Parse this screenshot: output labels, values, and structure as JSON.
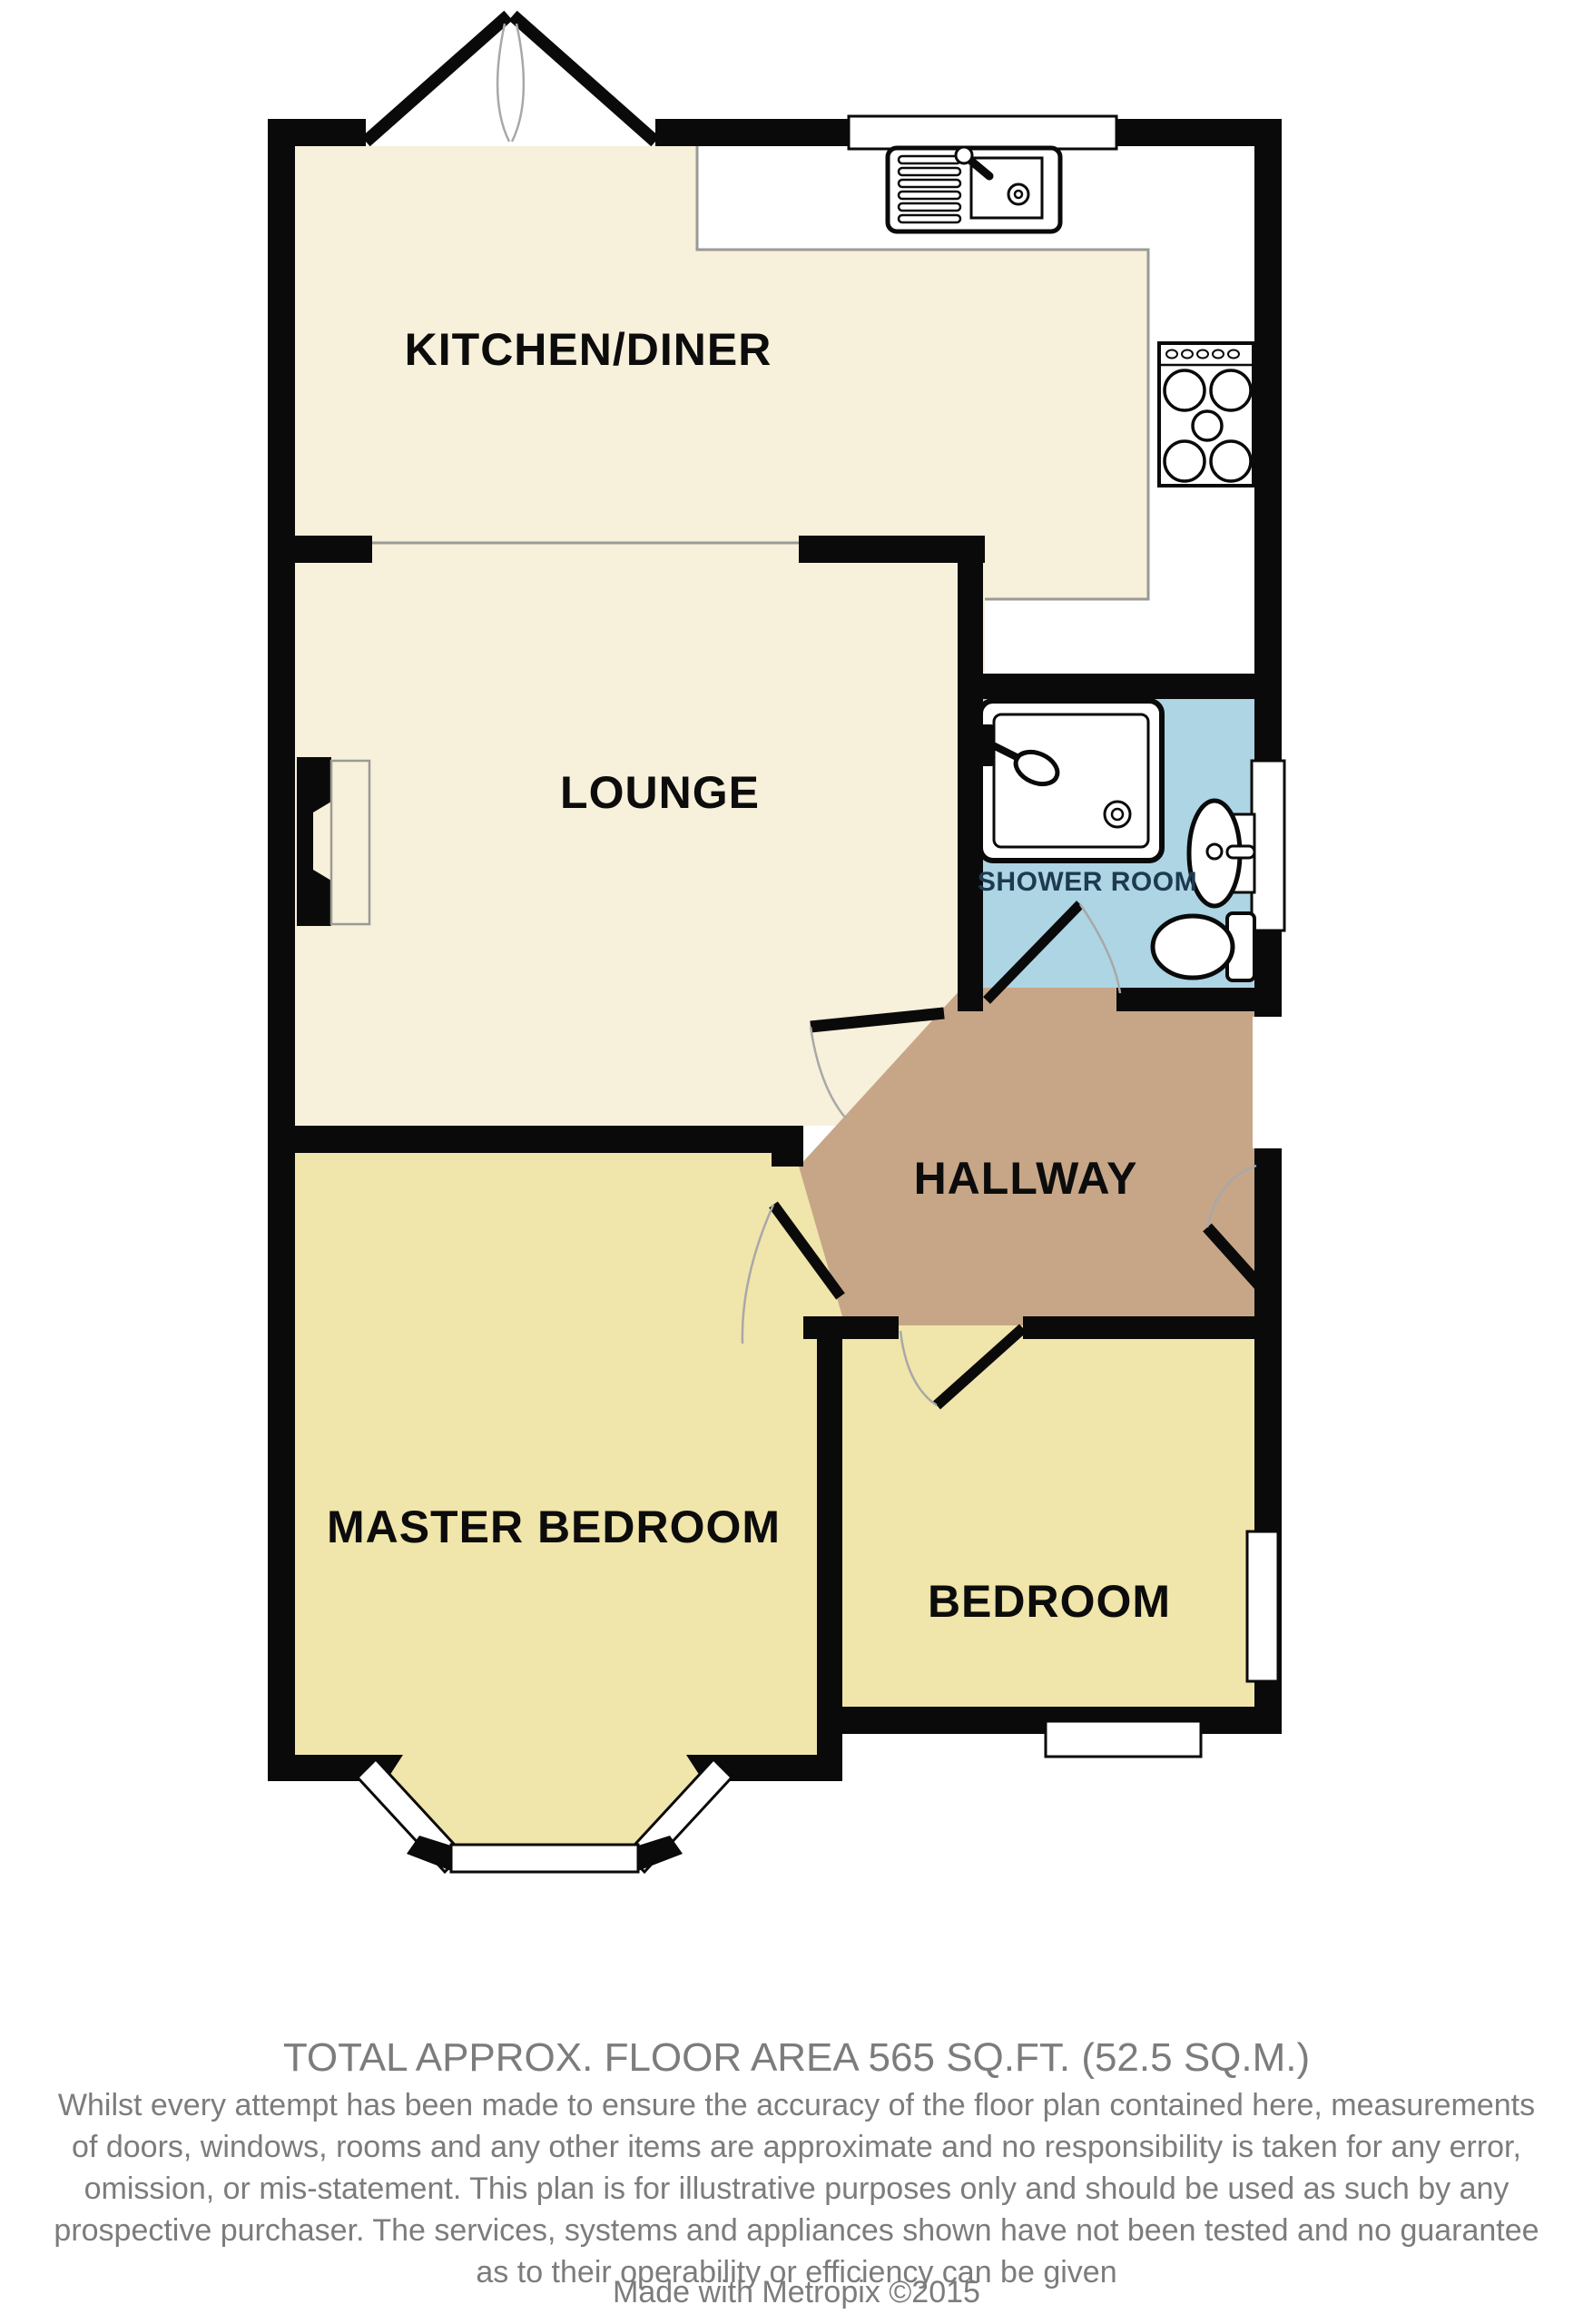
{
  "colors": {
    "wall": "#0a0a0a",
    "cream": "#f7f0da",
    "yellow": "#f0e5aa",
    "blue": "#add5e4",
    "brown": "#c7a687",
    "line-gray": "#9a9a96",
    "arc-gray": "#a8a8a8",
    "shower-text": "#1e3a50",
    "footer-gray": "#7c7c7c"
  },
  "rooms": {
    "kitchen": "KITCHEN/DINER",
    "lounge": "LOUNGE",
    "shower": "SHOWER ROOM",
    "hallway": "HALLWAY",
    "master": "MASTER BEDROOM",
    "bedroom": "BEDROOM"
  },
  "footer": {
    "area_line": "TOTAL APPROX. FLOOR AREA 565 SQ.FT. (52.5 SQ.M.)",
    "disclaimer_lines": [
      "Whilst every attempt has been made to ensure the accuracy of the floor plan contained here, measurements",
      "of doors, windows, rooms and any other items are approximate and no responsibility is taken for any error,",
      "omission, or mis-statement. This plan is for illustrative purposes only and should be used as such by any",
      "prospective purchaser. The services, systems and appliances shown have not been tested and no guarantee",
      "as to their operability or efficiency can be given"
    ],
    "credit": "Made with Metropix ©2015"
  }
}
